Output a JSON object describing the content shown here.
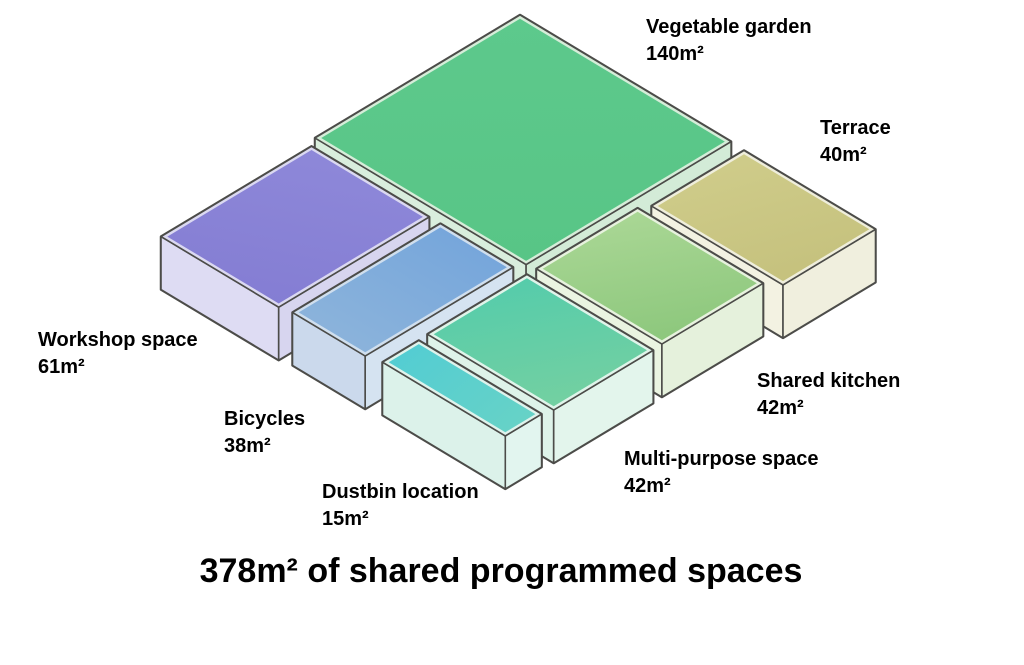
{
  "title": "378m² of shared programmed spaces",
  "total_area_m2": 378,
  "canvas": {
    "width": 1024,
    "height": 665,
    "background": "#ffffff"
  },
  "projection": {
    "origin_x": 520,
    "origin_y": 15,
    "scale_px_per_m": 17.3,
    "vertical_ratio": 0.6,
    "box_height_px": 53,
    "rim_inset_m": 0.18,
    "outline_color": "#4c4c49",
    "outline_width": 1.6,
    "silhouette_width": 2.5
  },
  "blocks": [
    {
      "id": "vegetable-garden",
      "label": "Vegetable garden",
      "area": "140m²",
      "area_m2": 140,
      "plan": {
        "u0": 0.0,
        "v0": 0.0,
        "du": 12.2,
        "dv": 11.85
      },
      "colors": {
        "top_back": "#5dc98c",
        "top_front": "#58c586",
        "side_left": "#d9eedd",
        "side_right": "#d3ebd7",
        "rim": "#d6edd9"
      },
      "label_pos": {
        "x": 646,
        "y": 14
      }
    },
    {
      "id": "workshop-space",
      "label": "Workshop space",
      "area": "61m²",
      "area_m2": 61,
      "plan": {
        "u0": 0.3,
        "v0": 12.35,
        "du": 6.8,
        "dv": 8.7
      },
      "colors": {
        "top_back": "#8e88d9",
        "top_front": "#847dd3",
        "side_left": "#dedcf3",
        "side_right": "#d7d5ef",
        "rim": "#dbd9f1"
      },
      "label_pos": {
        "x": 38,
        "y": 327
      }
    },
    {
      "id": "terrace",
      "label": "Terrace",
      "area": "40m²",
      "area_m2": 40,
      "plan": {
        "u0": 13.0,
        "v0": 0.05,
        "du": 7.6,
        "dv": 5.35
      },
      "colors": {
        "top_back": "#cfcc8a",
        "top_front": "#c5c17d",
        "side_left": "#f3f2e2",
        "side_right": "#f0efde",
        "rim": "#efeedc"
      },
      "label_pos": {
        "x": 820,
        "y": 115
      }
    },
    {
      "id": "shared-kitchen",
      "label": "Shared kitchen",
      "area": "42m²",
      "area_m2": 42,
      "plan": {
        "u0": 12.7,
        "v0": 5.9,
        "du": 7.25,
        "dv": 5.85
      },
      "colors": {
        "top_back": "#aad795",
        "top_front": "#8cc77c",
        "side_left": "#eaf4e1",
        "side_right": "#e5f1dc",
        "rim": "#e7f2de"
      },
      "label_pos": {
        "x": 757,
        "y": 368
      }
    },
    {
      "id": "bicycles",
      "label": "Bicycles",
      "area": "38m²",
      "area_m2": 38,
      "plan": {
        "u0": 7.75,
        "v0": 12.35,
        "du": 4.2,
        "dv": 8.55
      },
      "colors": {
        "top_back": "#76a6db",
        "top_front": "#8bb3db",
        "side_left": "#cbd9ec",
        "side_right": "#d5e3f1",
        "rim": "#d0dfee"
      },
      "label_pos": {
        "x": 224,
        "y": 406
      }
    },
    {
      "id": "multi-purpose-space",
      "label": "Multi-purpose space",
      "area": "42m²",
      "area_m2": 42,
      "plan": {
        "u0": 12.7,
        "v0": 12.3,
        "du": 7.3,
        "dv": 5.75
      },
      "colors": {
        "top_back": "#55ccab",
        "top_front": "#74d0a1",
        "side_left": "#def3e9",
        "side_right": "#e3f5ec",
        "rim": "#e0f4ea"
      },
      "label_pos": {
        "x": 624,
        "y": 446
      }
    },
    {
      "id": "dustbin-location",
      "label": "Dustbin location",
      "area": "15m²",
      "area_m2": 15,
      "plan": {
        "u0": 12.75,
        "v0": 18.6,
        "du": 7.1,
        "dv": 2.1
      },
      "colors": {
        "top_back": "#54cdd2",
        "top_front": "#66d2c7",
        "side_left": "#dcf2ea",
        "side_right": "#e2f5ef",
        "rim": "#dff3ec"
      },
      "label_pos": {
        "x": 322,
        "y": 479
      }
    }
  ]
}
